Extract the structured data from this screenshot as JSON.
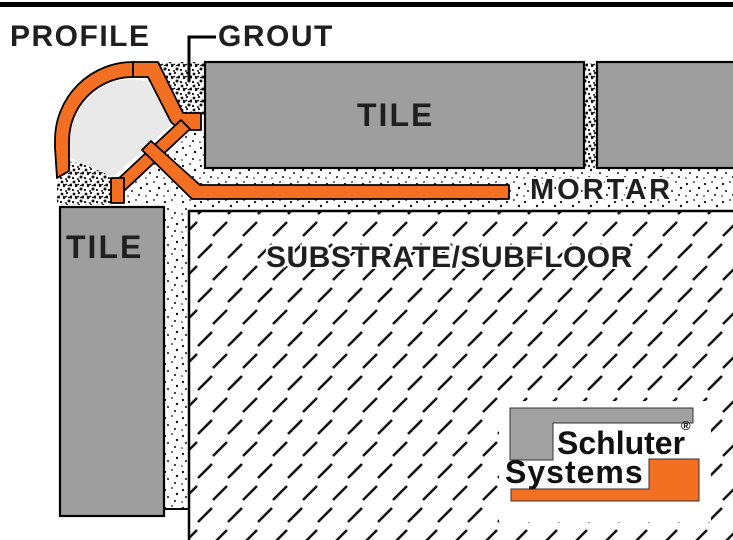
{
  "diagram": {
    "labels": {
      "profile": "PROFILE",
      "grout": "GROUT",
      "tile_top": "TILE",
      "tile_side": "TILE",
      "mortar": "MORTAR",
      "substrate": "SUBSTRATE/SUBFLOOR"
    },
    "logo": {
      "line1": "Schluter",
      "line2": "Systems",
      "registered_mark": "®"
    },
    "colors": {
      "profile_orange": "#F36F21",
      "tile_gray": "#9E9E9E",
      "logo_gray": "#A1A1A1",
      "profile_core_gray": "#E9E9E9",
      "text_ink": "#1F1F1F"
    }
  }
}
